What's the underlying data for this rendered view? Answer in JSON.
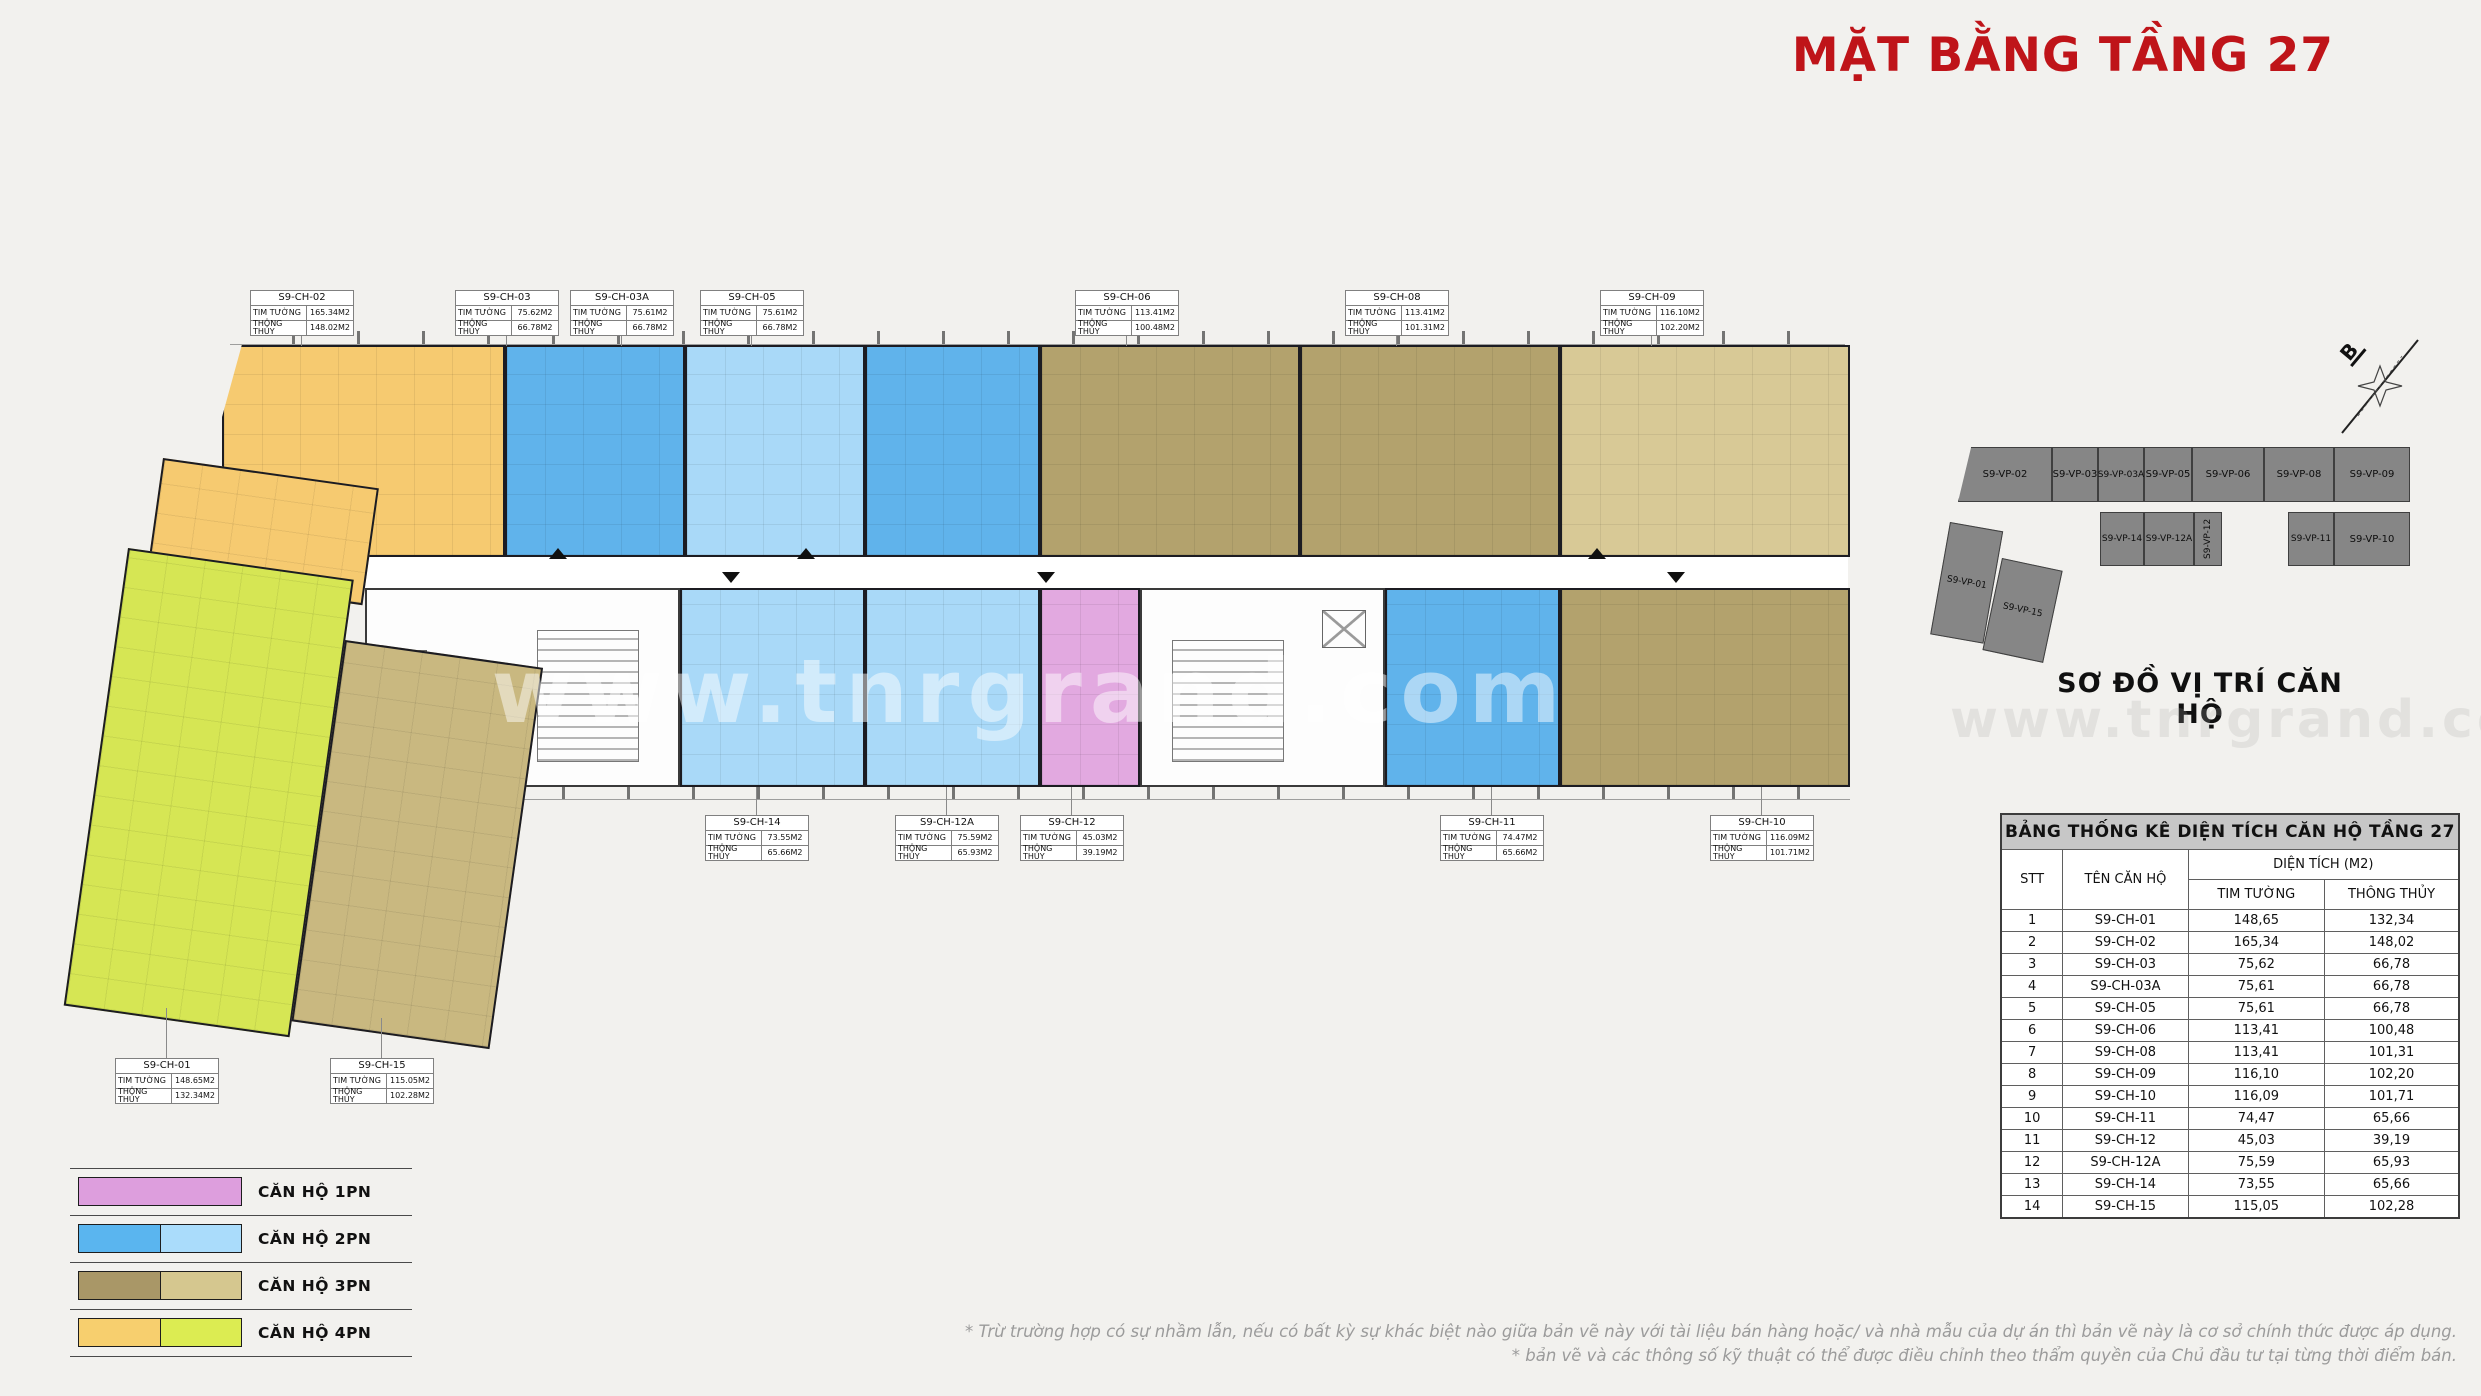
{
  "title": "MẶT BẰNG TẦNG 27",
  "watermark": "www.tnrgrand.com",
  "plan": {
    "labels": {
      "tim_tuong": "TIM TƯỜNG",
      "thong_thuy": "THÔNG THỦY"
    },
    "units": [
      {
        "name": "S9-CH-01",
        "type": "4PN",
        "tim_tuong": "148.65M2",
        "thong_thuy": "132.34M2"
      },
      {
        "name": "S9-CH-02",
        "type": "4PN",
        "tim_tuong": "165.34M2",
        "thong_thuy": "148.02M2"
      },
      {
        "name": "S9-CH-03",
        "type": "2PN",
        "tim_tuong": "75.62M2",
        "thong_thuy": "66.78M2"
      },
      {
        "name": "S9-CH-03A",
        "type": "2PN",
        "tim_tuong": "75.61M2",
        "thong_thuy": "66.78M2"
      },
      {
        "name": "S9-CH-05",
        "type": "2PN",
        "tim_tuong": "75.61M2",
        "thong_thuy": "66.78M2"
      },
      {
        "name": "S9-CH-06",
        "type": "3PN",
        "tim_tuong": "113.41M2",
        "thong_thuy": "100.48M2"
      },
      {
        "name": "S9-CH-08",
        "type": "3PN",
        "tim_tuong": "113.41M2",
        "thong_thuy": "101.31M2"
      },
      {
        "name": "S9-CH-09",
        "type": "3PN",
        "tim_tuong": "116.10M2",
        "thong_thuy": "102.20M2"
      },
      {
        "name": "S9-CH-10",
        "type": "3PN",
        "tim_tuong": "116.09M2",
        "thong_thuy": "101.71M2"
      },
      {
        "name": "S9-CH-11",
        "type": "2PN",
        "tim_tuong": "74.47M2",
        "thong_thuy": "65.66M2"
      },
      {
        "name": "S9-CH-12",
        "type": "1PN",
        "tim_tuong": "45.03M2",
        "thong_thuy": "39.19M2"
      },
      {
        "name": "S9-CH-12A",
        "type": "2PN",
        "tim_tuong": "75.59M2",
        "thong_thuy": "65.93M2"
      },
      {
        "name": "S9-CH-14",
        "type": "2PN",
        "tim_tuong": "73.55M2",
        "thong_thuy": "65.66M2"
      },
      {
        "name": "S9-CH-15",
        "type": "3PN",
        "tim_tuong": "115.05M2",
        "thong_thuy": "102.28M2"
      }
    ]
  },
  "minimap": {
    "caption": "SƠ ĐỒ VỊ TRÍ CĂN HỘ",
    "compass_label": "B",
    "units": [
      "S9-VP-01",
      "S9-VP-02",
      "S9-VP-03",
      "S9-VP-03A",
      "S9-VP-05",
      "S9-VP-06",
      "S9-VP-08",
      "S9-VP-09",
      "S9-VP-10",
      "S9-VP-11",
      "S9-VP-12",
      "S9-VP-12A",
      "S9-VP-14",
      "S9-VP-15"
    ]
  },
  "table": {
    "title": "BẢNG THỐNG KÊ DIỆN TÍCH CĂN HỘ TẦNG 27",
    "headers": {
      "stt": "STT",
      "ten_can_ho": "TÊN CĂN HỘ",
      "dien_tich": "DIỆN TÍCH (M2)",
      "tim_tuong": "TIM TƯỜNG",
      "thong_thuy": "THÔNG THỦY"
    },
    "rows": [
      [
        "1",
        "S9-CH-01",
        "148,65",
        "132,34"
      ],
      [
        "2",
        "S9-CH-02",
        "165,34",
        "148,02"
      ],
      [
        "3",
        "S9-CH-03",
        "75,62",
        "66,78"
      ],
      [
        "4",
        "S9-CH-03A",
        "75,61",
        "66,78"
      ],
      [
        "5",
        "S9-CH-05",
        "75,61",
        "66,78"
      ],
      [
        "6",
        "S9-CH-06",
        "113,41",
        "100,48"
      ],
      [
        "7",
        "S9-CH-08",
        "113,41",
        "101,31"
      ],
      [
        "8",
        "S9-CH-09",
        "116,10",
        "102,20"
      ],
      [
        "9",
        "S9-CH-10",
        "116,09",
        "101,71"
      ],
      [
        "10",
        "S9-CH-11",
        "74,47",
        "65,66"
      ],
      [
        "11",
        "S9-CH-12",
        "45,03",
        "39,19"
      ],
      [
        "12",
        "S9-CH-12A",
        "75,59",
        "65,93"
      ],
      [
        "13",
        "S9-CH-14",
        "73,55",
        "65,66"
      ],
      [
        "14",
        "S9-CH-15",
        "115,05",
        "102,28"
      ]
    ]
  },
  "legend": {
    "items": [
      {
        "label": "CĂN HỘ 1PN",
        "colors": [
          "#dd9edd"
        ]
      },
      {
        "label": "CĂN HỘ 2PN",
        "colors": [
          "#5ab5ef",
          "#aadcfb"
        ]
      },
      {
        "label": "CĂN HỘ 3PN",
        "colors": [
          "#a99767",
          "#d5c78f"
        ]
      },
      {
        "label": "CĂN HỘ 4PN",
        "colors": [
          "#f7cf6e",
          "#dcec52"
        ]
      }
    ]
  },
  "footnotes": [
    "* Trừ trường hợp có sự nhầm lẫn, nếu có bất kỳ sự khác biệt nào giữa bản vẽ này với tài liệu bán hàng hoặc/ và nhà mẫu của dự án thì bản vẽ này là cơ sở chính thức được áp dụng.",
    "* bản vẽ và các thông số kỹ thuật có thể được điều chỉnh theo thẩm quyền của Chủ đầu tư tại từng thời điểm bán."
  ]
}
